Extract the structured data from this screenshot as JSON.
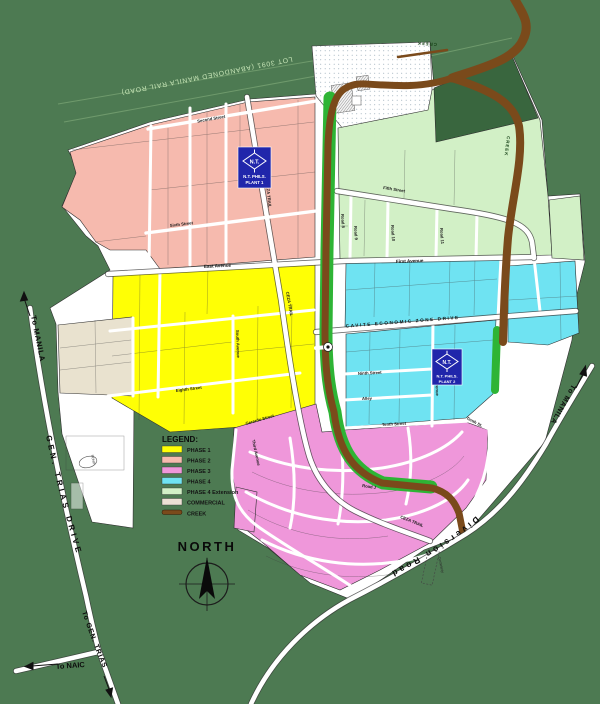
{
  "map": {
    "labels": {
      "railroad_lot": "LOT 3091 (ABANDONED MANILA RAIL ROAD)",
      "creek": "CREEK",
      "cemetery": "Cemetery",
      "pond": "POND",
      "north": "NORTH"
    },
    "plants": [
      {
        "logo": "N.T.",
        "line1": "N.T. PHILS.",
        "line2": "PLANT 1"
      },
      {
        "logo": "N.T.",
        "line1": "N.T. PHILS.",
        "line2": "PLANT 2"
      }
    ],
    "roads": {
      "to_manila_left": "To MANILA",
      "gen_trias_drive": "GEN. TRIAS DRIVE",
      "to_gen_trias": "To GEN. TRIAS",
      "to_naic": "To NAIC",
      "to_manila_right": "To MANILA",
      "diversion_road": "Diversion Road",
      "ceza_drive": "CAVITE ECONOMIC ZONE DRIVE",
      "east_avenue": "East Avenue",
      "first_avenue": "First Avenue",
      "second_street": "Second Street",
      "fifth_street": "Fifth Street",
      "sixth_street": "Sixth Street",
      "eighth_street": "Eighth Street",
      "ninth_street": "Ninth Street",
      "tenth_street": "Tenth Street",
      "tenth_st_abbrev": "Tenth St.",
      "alley": "Alley",
      "south_avenue": "South Avenue",
      "third_avenue": "Third Avenue",
      "gerardo_street": "Gerardo Street",
      "ceza_trail": "CEZA TRAIL",
      "road_j": "Road J",
      "road_8": "Road 8",
      "road_9": "Road 9",
      "road_10": "Road 10",
      "road_11": "Road 11"
    },
    "legend": {
      "title": "LEGEND:",
      "items": [
        {
          "label": "PHASE 1",
          "color": "#ffff05"
        },
        {
          "label": "PHASE 2",
          "color": "#f6baae"
        },
        {
          "label": "PHASE 3",
          "color": "#ef97da"
        },
        {
          "label": "PHASE 4",
          "color": "#6fe3f2"
        },
        {
          "label": "PHASE 4 Extension",
          "color": "#d2f0c6"
        },
        {
          "label": "COMMERCIAL",
          "color": "#ece0d4"
        },
        {
          "label": "CREEK",
          "color": "#7a4a1b"
        }
      ]
    },
    "colors": {
      "background": "#4d7a52",
      "estate_base": "#ffffff",
      "phase1": "#ffff05",
      "phase2": "#f6baae",
      "phase3": "#ef97da",
      "phase4": "#6fe3f2",
      "phase4ext": "#d2f0c6",
      "commercial": "#e9e2cf",
      "creek": "#7a4a1b",
      "green_strip": "#2eb435",
      "forest": "#39663e",
      "plant_blue": "#2026ab",
      "rail_text": "#c8e6b8"
    }
  }
}
